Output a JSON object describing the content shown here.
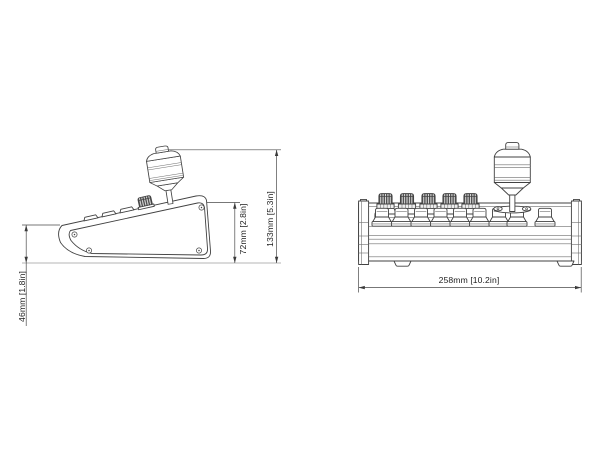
{
  "drawing": {
    "background": "#ffffff",
    "line_color": "#414141",
    "dimensions": {
      "side_base_height": "46mm [1.8in]",
      "side_body_height": "72mm [2.8in]",
      "side_total_height": "133mm [5.3in]",
      "front_width": "258mm [10.2in]"
    }
  }
}
